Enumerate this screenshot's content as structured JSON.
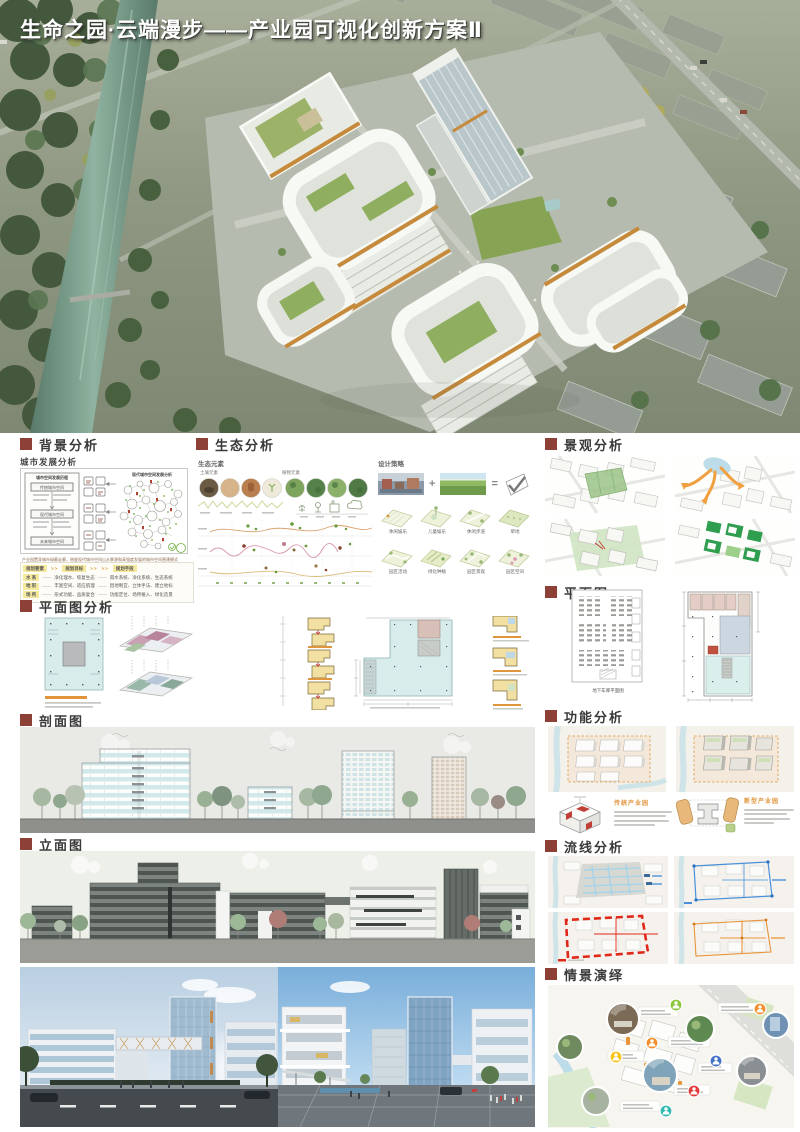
{
  "poster": {
    "title": "生命之园·云端漫步——产业园可视化创新方案Ⅱ"
  },
  "theme": {
    "section_marker_color": "#8d4136",
    "caption_orange": "#e0953c",
    "plan_cyan": "#d9ecec",
    "diagram_yellow": "#f2dfa2",
    "highlight_yellow": "#f5e9a0"
  },
  "background": {
    "title": "背景分析",
    "subtitle": "城市发展分析",
    "diagram": {
      "left_title": "城市空间发展历程",
      "right_title": "现代城市空间发展分析",
      "flow": [
        "传统城市空间",
        "现代城市空间",
        "未来城市空间"
      ]
    },
    "note": "产业园置身城市绿廊走廊，借鉴现代城市空间山水景源和高强度发展的城市空间营建模式",
    "table": {
      "headers": [
        "规划要素",
        "规划目标",
        "规划手段"
      ],
      "rows": [
        {
          "element": "水 系",
          "goal": "净化理水、恢复生态",
          "means": "雨水系统、净化系统、生态系统"
        },
        {
          "element": "地 形",
          "goal": "丰富空间、适应肌理",
          "means": "因地制宜、立体手法、建立地标"
        },
        {
          "element": "场 所",
          "goal": "形式功能、品质复合",
          "means": "功能定位、场所植入、绿化造景"
        }
      ]
    }
  },
  "ecology": {
    "title": "生态分析",
    "elements_label": "生态元素",
    "soil_label": "土壤元素",
    "plant_label": "植物元素",
    "strategy_label": "设计策略",
    "tiles": [
      "休闲娱乐",
      "儿童娱乐",
      "休闲步道",
      "草地",
      "园区活动",
      "绿化种植",
      "园区景观",
      "园区空间"
    ]
  },
  "landscape": {
    "title": "景观分析"
  },
  "plan_analysis": {
    "title": "平面图分析"
  },
  "plan": {
    "title": "平面图",
    "garage_caption": "地下车库平面图"
  },
  "section_drawing": {
    "title": "剖面图"
  },
  "function": {
    "title": "功能分析",
    "left_label": "传统产业园",
    "right_label": "新型产业园"
  },
  "elevation": {
    "title": "立面图"
  },
  "circulation": {
    "title": "流线分析"
  },
  "scenario": {
    "title": "情景演绎"
  }
}
